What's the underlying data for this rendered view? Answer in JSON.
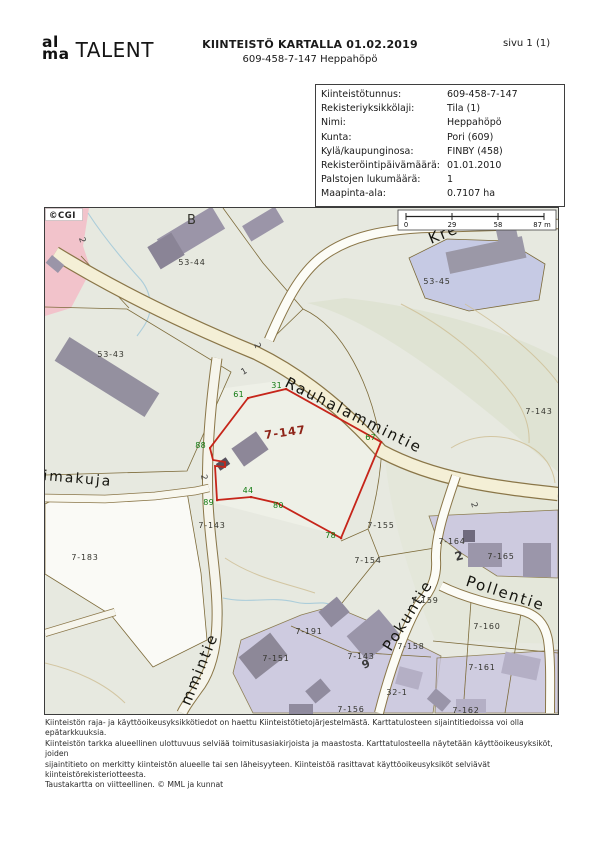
{
  "header": {
    "logo": {
      "line1": "al",
      "line2": "ma",
      "wordmark": "TALENT"
    },
    "title": "KIINTEISTÖ KARTALLA 01.02.2019",
    "subtitle": "609-458-7-147 Heppahöpö",
    "page_label": "sivu 1 (1)"
  },
  "info_panel": {
    "rows": [
      {
        "label": "Kiinteistötunnus:",
        "value": "609-458-7-147"
      },
      {
        "label": "Rekisteriyksikkölaji:",
        "value": "Tila (1)"
      },
      {
        "label": "Nimi:",
        "value": "Heppahöpö"
      },
      {
        "label": "Kunta:",
        "value": "Pori (609)"
      },
      {
        "label": "Kylä/kaupunginosa:",
        "value": "FINBY (458)"
      },
      {
        "label": "Rekisteröintipäivämäärä:",
        "value": "01.01.2010"
      },
      {
        "label": "Palstojen lukumäärä:",
        "value": "1"
      },
      {
        "label": "Maapinta-ala:",
        "value": "0.7107 ha"
      }
    ]
  },
  "map": {
    "copyright": "©CGI",
    "scale_bar": {
      "ticks": [
        "0",
        "29",
        "58",
        "87 m"
      ]
    },
    "colors": {
      "boundary_red": "#c6251a",
      "vertex_green": "#117a11",
      "property_label_red": "#8e2418"
    },
    "property_label": {
      "text": "7-147",
      "x": 220,
      "y": 231,
      "rot": -8,
      "name": "property-number-label"
    },
    "street_labels": [
      {
        "text": "Rauhalammintie",
        "x": 239,
        "y": 178,
        "rot": 26.5,
        "name": "street-label-rauhalammintie"
      },
      {
        "text": "Kre",
        "x": 386,
        "y": 36,
        "rot": -22,
        "name": "street-label-kre"
      },
      {
        "text": "imakuja",
        "x": -2,
        "y": 272,
        "rot": 5,
        "size": 14,
        "name": "street-label-imakuja"
      },
      {
        "text": "mmintie",
        "x": 159,
        "y": 463,
        "rot": -68,
        "anchor": "middle",
        "name": "street-label-mmintie"
      },
      {
        "text": "Pokuntie",
        "x": 367,
        "y": 410,
        "rot": -58,
        "anchor": "middle",
        "name": "street-label-pokuntie"
      },
      {
        "text": "Pollentie",
        "x": 459,
        "y": 390,
        "rot": 18,
        "anchor": "middle",
        "name": "street-label-pollentie"
      }
    ],
    "parcel_labels": [
      {
        "text": "B",
        "x": 142,
        "y": 16,
        "size": 13,
        "name": "building-letter-b"
      },
      {
        "text": "53-44",
        "x": 147,
        "y": 57,
        "anchor": "middle"
      },
      {
        "text": "53-43",
        "x": 66,
        "y": 149,
        "anchor": "middle"
      },
      {
        "text": "53-45",
        "x": 392,
        "y": 76,
        "anchor": "middle"
      },
      {
        "text": "7-143",
        "x": 494,
        "y": 206,
        "anchor": "middle"
      },
      {
        "text": "7-183",
        "x": 40,
        "y": 352,
        "anchor": "middle"
      },
      {
        "text": "7-143",
        "x": 167,
        "y": 320,
        "anchor": "middle"
      },
      {
        "text": "7-155",
        "x": 336,
        "y": 320,
        "anchor": "middle"
      },
      {
        "text": "7-154",
        "x": 323,
        "y": 355,
        "anchor": "middle"
      },
      {
        "text": "7-191",
        "x": 264,
        "y": 426,
        "anchor": "middle"
      },
      {
        "text": "7-151",
        "x": 231,
        "y": 453,
        "anchor": "middle"
      },
      {
        "text": "7-143",
        "x": 316,
        "y": 451,
        "anchor": "middle"
      },
      {
        "text": "7-156",
        "x": 306,
        "y": 504,
        "anchor": "middle"
      },
      {
        "text": "32-1",
        "x": 352,
        "y": 487,
        "anchor": "middle"
      },
      {
        "text": "7-164",
        "x": 407,
        "y": 336,
        "anchor": "middle"
      },
      {
        "text": "7-165",
        "x": 456,
        "y": 351,
        "anchor": "middle"
      },
      {
        "text": "7-159",
        "x": 380,
        "y": 395,
        "anchor": "middle"
      },
      {
        "text": "7-158",
        "x": 366,
        "y": 441,
        "anchor": "middle"
      },
      {
        "text": "7-160",
        "x": 442,
        "y": 421,
        "anchor": "middle"
      },
      {
        "text": "7-161",
        "x": 437,
        "y": 462,
        "anchor": "middle"
      },
      {
        "text": "7-162",
        "x": 421,
        "y": 505,
        "anchor": "middle"
      }
    ],
    "vertex_labels": [
      {
        "text": "61",
        "x": 199,
        "y": 189,
        "anchor": "end"
      },
      {
        "text": "31",
        "x": 237,
        "y": 180,
        "anchor": "end"
      },
      {
        "text": "88",
        "x": 161,
        "y": 240,
        "anchor": "end"
      },
      {
        "text": "89",
        "x": 169,
        "y": 297,
        "anchor": "end"
      },
      {
        "text": "44",
        "x": 203,
        "y": 285,
        "anchor": "middle"
      },
      {
        "text": "80",
        "x": 228,
        "y": 300
      },
      {
        "text": "78",
        "x": 291,
        "y": 330,
        "anchor": "end"
      },
      {
        "text": "67",
        "x": 331,
        "y": 232,
        "anchor": "end"
      }
    ],
    "address_labels": [
      {
        "text": "2",
        "x": 34,
        "y": 30,
        "rot": 75
      },
      {
        "text": "2",
        "x": 209,
        "y": 136,
        "rot": 70
      },
      {
        "text": "1",
        "x": 198,
        "y": 167,
        "rot": -30
      },
      {
        "text": "2",
        "x": 156,
        "y": 267,
        "rot": 80
      },
      {
        "text": "2",
        "x": 426,
        "y": 295,
        "rot": 75
      },
      {
        "text": "2",
        "x": 411,
        "y": 353,
        "rot": -15,
        "size": 12,
        "bold": true
      },
      {
        "text": "9",
        "x": 319,
        "y": 461,
        "rot": -25,
        "size": 11,
        "bold": true
      }
    ]
  },
  "footer": {
    "lines": [
      "Kiinteistön raja- ja käyttöoikeusyksikkötiedot on haettu Kiinteistötietojärjestelmästä. Karttatulosteen sijaintitiedoissa voi olla epätarkkuuksia.",
      "Kiinteistön tarkka alueellinen ulottuvuus selviää toimitusasiakirjoista ja maastosta. Karttatulosteella näytetään käyttöoikeusyksiköt, joiden",
      "sijaintitieto on merkitty kiinteistön alueelle tai sen läheisyyteen. Kiinteistöä rasittavat käyttöoikeusyksiköt selviävät kiinteistörekisteriotteesta.",
      "Taustakartta on viitteellinen. © MML ja kunnat"
    ]
  }
}
